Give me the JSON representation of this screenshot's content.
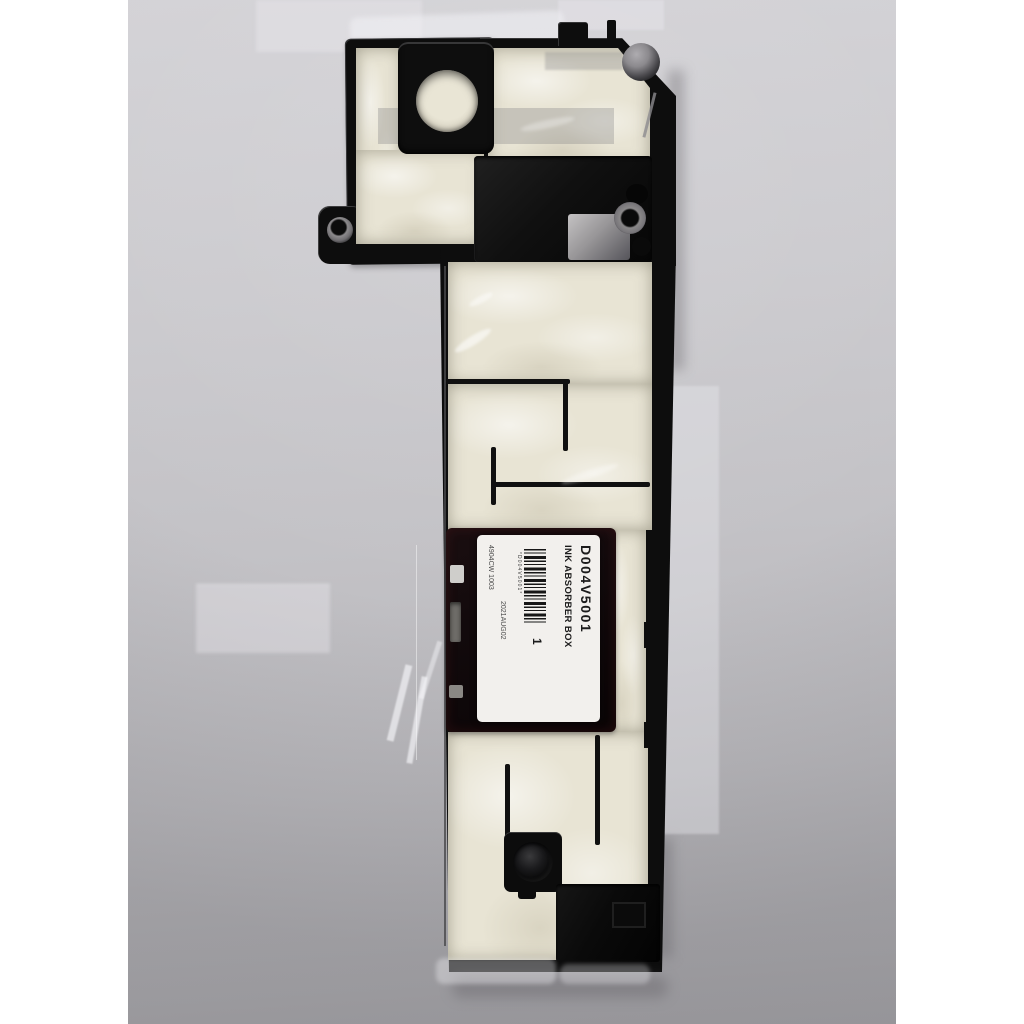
{
  "label": {
    "part_number": "D004V5001",
    "part_name": "INK ABSORBER BOX",
    "barcode_text": "*D004V5001*",
    "quantity": "1",
    "date_code": "2021AUG02",
    "lot_code": "4904CW 1003"
  },
  "colors": {
    "background_gray": "#c3c2c6",
    "foam_beige": "#e8e4d4",
    "plastic_black": "#0d0d0d",
    "label_white": "#f2f0ed",
    "letterbox_white": "#ffffff"
  }
}
